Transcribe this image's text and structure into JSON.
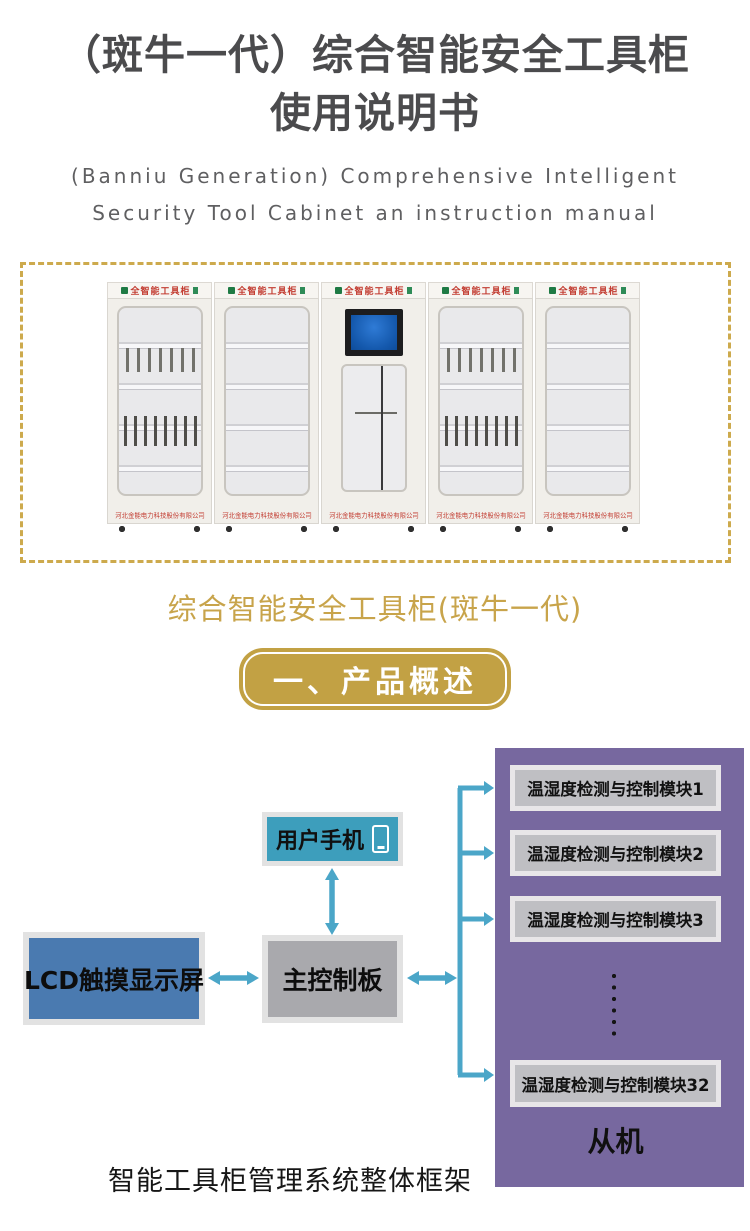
{
  "page": {
    "title_line1": "（斑牛一代）综合智能安全工具柜",
    "title_line2": "使用说明书",
    "subtitle_line1": "(Banniu Generation) Comprehensive Intelligent",
    "subtitle_line2": "Security Tool Cabinet an instruction manual"
  },
  "gallery": {
    "cabinet_header": "全智能工具柜",
    "cabinet_footer": "河北金能电力科技股份有限公司",
    "caption": "综合智能安全工具柜(斑牛一代)"
  },
  "section_badge": {
    "label": "一、产品概述"
  },
  "diagram": {
    "nodes": {
      "phone": "用户手机",
      "lcd": "LCD触摸显示屏",
      "mainboard": "主控制板"
    },
    "slave_panel": {
      "modules": [
        {
          "label": "温湿度检测与控制模块1"
        },
        {
          "label": "温湿度检测与控制模块2"
        },
        {
          "label": "温湿度检测与控制模块3"
        },
        {
          "label": "温湿度检测与控制模块32"
        }
      ],
      "label": "从机"
    },
    "caption": "智能工具柜管理系统整体框架"
  },
  "colors": {
    "accent_gold": "#CDAA4D",
    "caption_gold": "#C8A44B",
    "badge_gold": "#C2A144",
    "arrow_teal": "#4BA6C8",
    "phone_box_teal": "#3D9EBC",
    "lcd_box_blue": "#4A7AB0",
    "mainboard_gray": "#A9A9AD",
    "module_gray": "#BFBFC3",
    "panel_purple": "#77689F",
    "cabinet_red": "#C23B30",
    "title_gray": "#4B4B4D"
  }
}
